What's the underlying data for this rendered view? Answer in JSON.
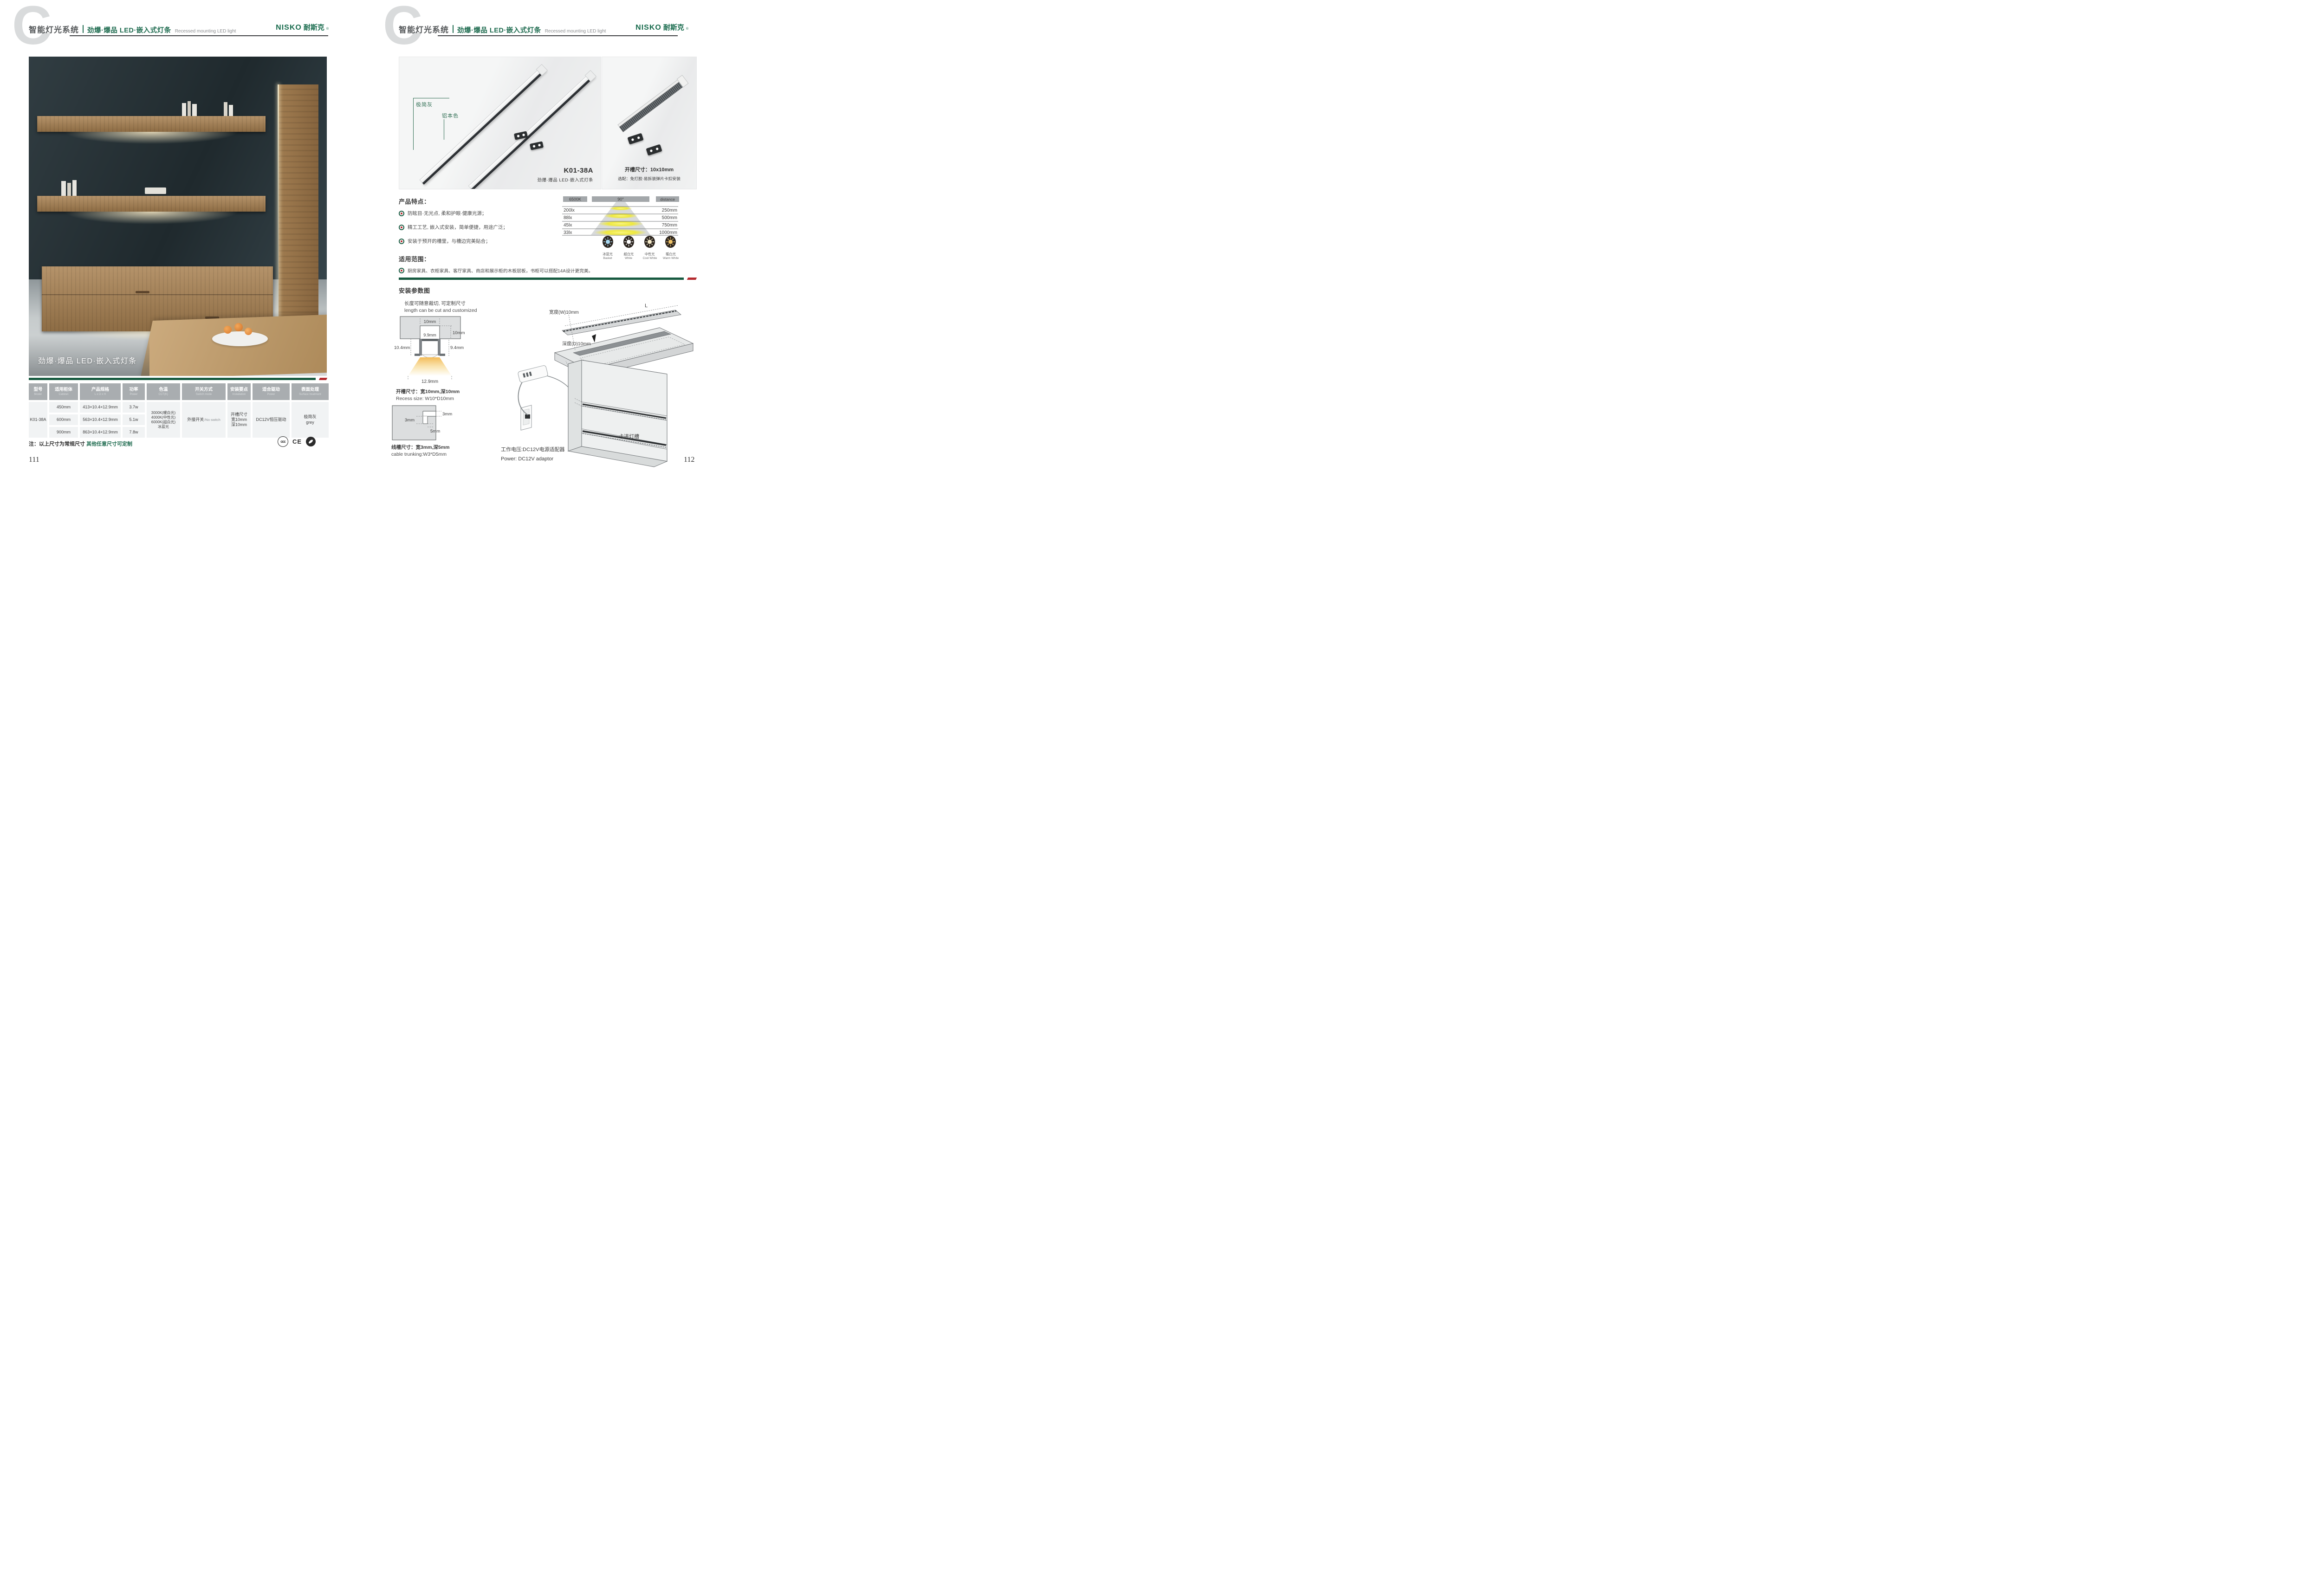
{
  "meta": {
    "left_page_number": "111",
    "right_page_number": "112"
  },
  "colors": {
    "brand_green": "#1e6b4f",
    "accent_red": "#b4292e",
    "table_header_gray": "#a9adb0"
  },
  "brand": {
    "latin": "NISKO",
    "cn": "耐斯克",
    "reg": "®"
  },
  "header": {
    "watermark": "C",
    "system_title": "智能灯光系统",
    "product_title": "劲爆·爆品  LED·嵌入式灯条",
    "product_subtitle": "Recessed mounting LED light"
  },
  "left_page": {
    "photo_caption": "劲爆·爆品 LED·嵌入式灯条",
    "table": {
      "headers": [
        {
          "cn": "型号",
          "en": "Model"
        },
        {
          "cn": "适用柜体",
          "en": "Cabinet"
        },
        {
          "cn": "产品规格",
          "en": "L x D x H"
        },
        {
          "cn": "功率",
          "en": "Power"
        },
        {
          "cn": "色温",
          "en": "CCT(K)"
        },
        {
          "cn": "开关方式",
          "en": "Switch mode"
        },
        {
          "cn": "安装要点",
          "en": "Installation"
        },
        {
          "cn": "适合驱动",
          "en": "Power"
        },
        {
          "cn": "表面处理",
          "en": "Surface treatment"
        }
      ],
      "model": "K01-38A",
      "variants": [
        {
          "cabinet": "450mm",
          "spec": "413×10.4×12.9mm",
          "power": "3.7w"
        },
        {
          "cabinet": "600mm",
          "spec": "563×10.4×12.9mm",
          "power": "5.1w"
        },
        {
          "cabinet": "900mm",
          "spec": "863×10.4×12.9mm",
          "power": "7.8w"
        }
      ],
      "cct_lines": [
        "3000K(暖白光)",
        "4000K(中性光)",
        "6000K(超白光)",
        "冰蓝光"
      ],
      "switch_cn": "外接开关",
      "switch_en": "/No switch",
      "install_lines": [
        "开槽尺寸",
        "宽10mm",
        "深10mm"
      ],
      "driver": "DC12V恒压驱动",
      "surface_cn": "极简灰",
      "surface_en": "grey"
    },
    "note_prefix": "注：以上尺寸为常规尺寸 ",
    "note_highlight": "其他任意尺寸可定制",
    "certs": {
      "ccc": "ccc",
      "ce": "CE"
    }
  },
  "right_page": {
    "gallery": {
      "strip1_label": "极简灰",
      "strip2_label": "铝本色",
      "model": "K01-38A",
      "model_caption": "劲爆·爆品 LED·嵌入式灯条",
      "accessory_line1": "开槽尺寸：10x10mm",
      "accessory_line2": "选配：免打胶·易拆装弹片卡扣安装"
    },
    "features": {
      "title": "产品特点：",
      "items": [
        "防眩目·无光点, 柔和护眼·健康光源；",
        "精工工艺, 嵌入式安装，简单便捷，用途广泛；",
        "安装于预开的槽里，与槽边完美贴合；"
      ]
    },
    "beam_chart": {
      "headers": [
        "6500K",
        "90°",
        "distance"
      ],
      "lux": [
        "200lx",
        "88lx",
        "45lx",
        "33lx"
      ],
      "distance": [
        "250mm",
        "500mm",
        "750mm",
        "1000mm"
      ]
    },
    "application": {
      "title": "适用范围：",
      "text": "厨房家具、衣柜家具、客厅家具、商店和展示柜的木板层板，书柜可以搭配14A设计更完美。"
    },
    "cct_icons": [
      {
        "cn": "冰蓝光",
        "en": "Basket",
        "color": "#a8d9f2"
      },
      {
        "cn": "超白光",
        "en": "White",
        "color": "#ffffff"
      },
      {
        "cn": "中性光",
        "en": "Cool White",
        "color": "#f7eccb"
      },
      {
        "cn": "暖白光",
        "en": "Warm White",
        "color": "#f0c469"
      }
    ],
    "install": {
      "title": "安装参数图",
      "cut_note_cn": "长度可随意裁切, 可定制尺寸",
      "cut_note_en": "length can be cut and customized",
      "cross_section": {
        "top_width": "10mm",
        "notch_depth": "10mm",
        "inner_width": "9.9mm",
        "left_height": "10.4mm",
        "right_height": "9.4mm",
        "beam_width": "12.9mm"
      },
      "recess_cn": "开槽尺寸：宽10mm,深10mm",
      "recess_en": "Recess size: W10*D10mm",
      "trunk": {
        "right": "3mm",
        "left": "3mm",
        "bottom": "5mm"
      },
      "trunking_cn": "线槽尺寸：宽3mm,深5mm",
      "trunking_en": "cable trunking:W3*D5mm",
      "plank": {
        "strip_length": "L",
        "groove_length": "L",
        "width": "宽度(W)10mm",
        "depth": "深度(D)10mm",
        "caption": "建议开槽尺寸"
      },
      "power_cn": "工作电压:DC12V电源适配器",
      "power_en": "Power: DC12V adaptor",
      "clip_note": "卡进灯槽"
    }
  },
  "chart_data": {
    "type": "table",
    "title": "Beam illuminance vs distance",
    "cct": "6500K",
    "beam_angle": "90°",
    "columns": [
      "illuminance",
      "distance"
    ],
    "rows": [
      [
        "200lx",
        "250mm"
      ],
      [
        "88lx",
        "500mm"
      ],
      [
        "45lx",
        "750mm"
      ],
      [
        "33lx",
        "1000mm"
      ]
    ]
  }
}
